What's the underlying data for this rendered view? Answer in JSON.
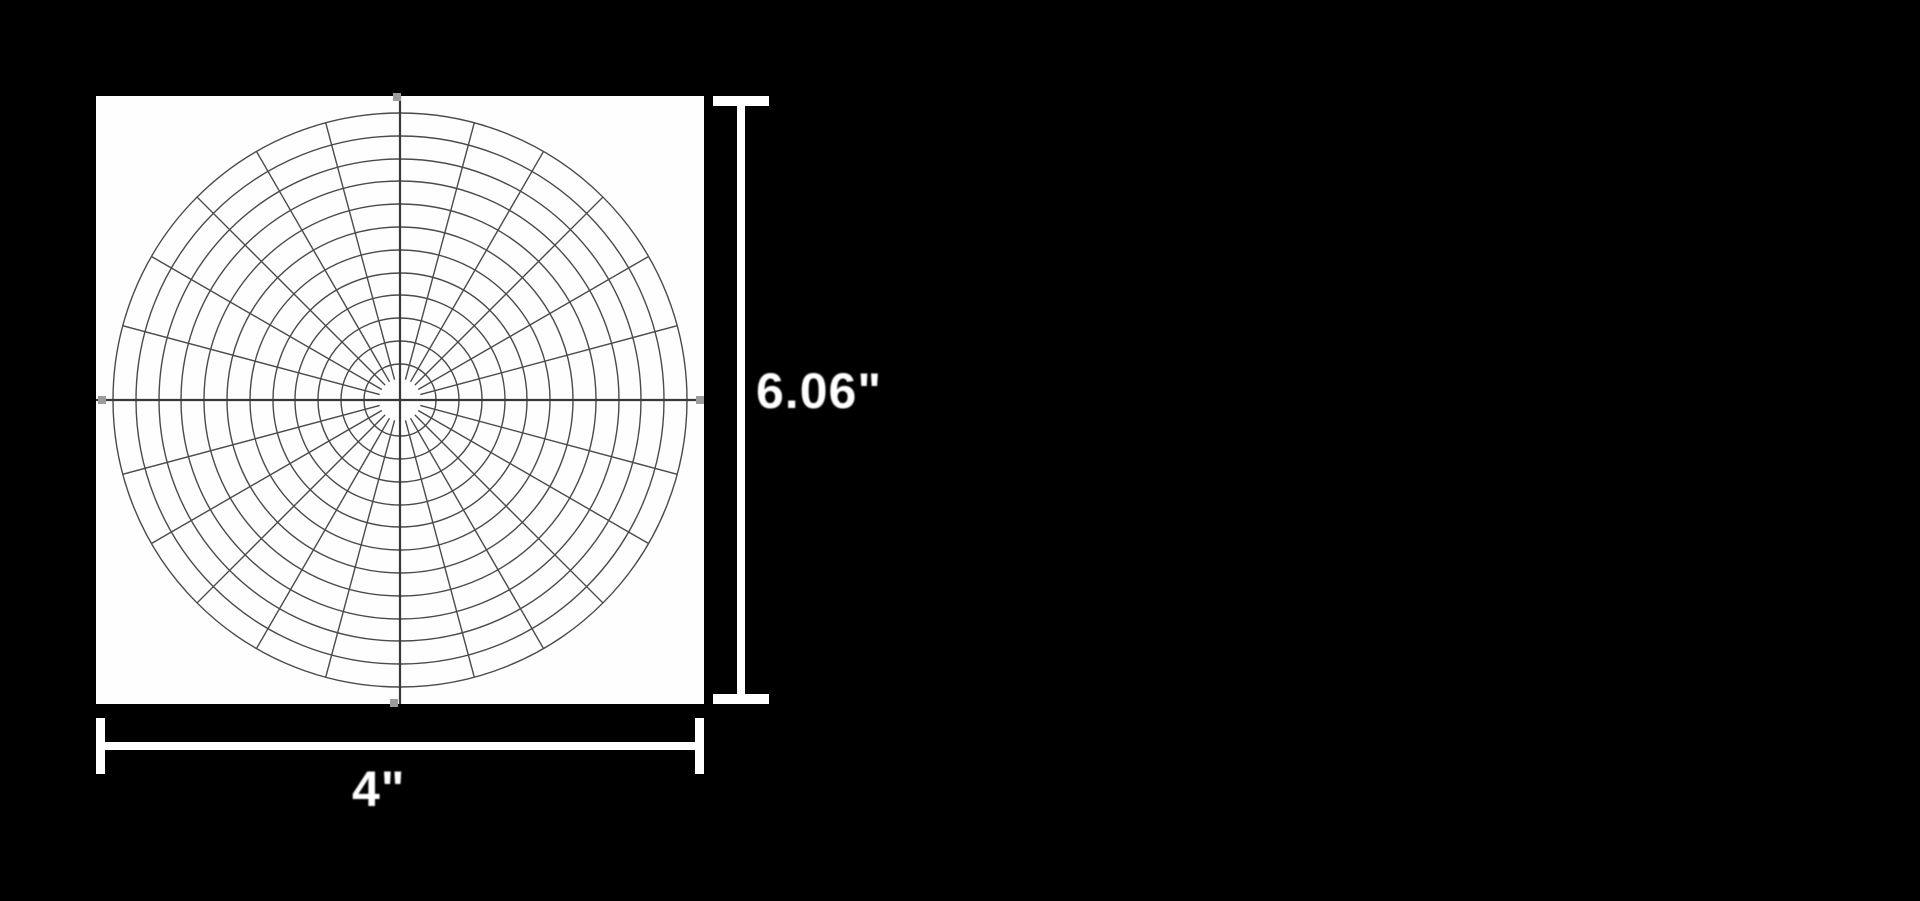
{
  "figure": {
    "type": "polar-grid-dimension-diagram",
    "background_color": "#000000",
    "paper": {
      "fill": "#fefefe"
    },
    "grid": {
      "line_color": "#4a4a4a",
      "axis_color": "#383838",
      "tip_handle_color": "#9c9c9c",
      "hole_radius": 21,
      "ring_radii": [
        36,
        59,
        82,
        105,
        127,
        150,
        173,
        196,
        219,
        241,
        264,
        287
      ],
      "outer_radius": 287,
      "spoke_count": 24,
      "spoke_step_degrees": 15
    },
    "dimensions": {
      "color": "#ffffff",
      "height_label": "6.06\"",
      "width_label": "4\""
    }
  }
}
